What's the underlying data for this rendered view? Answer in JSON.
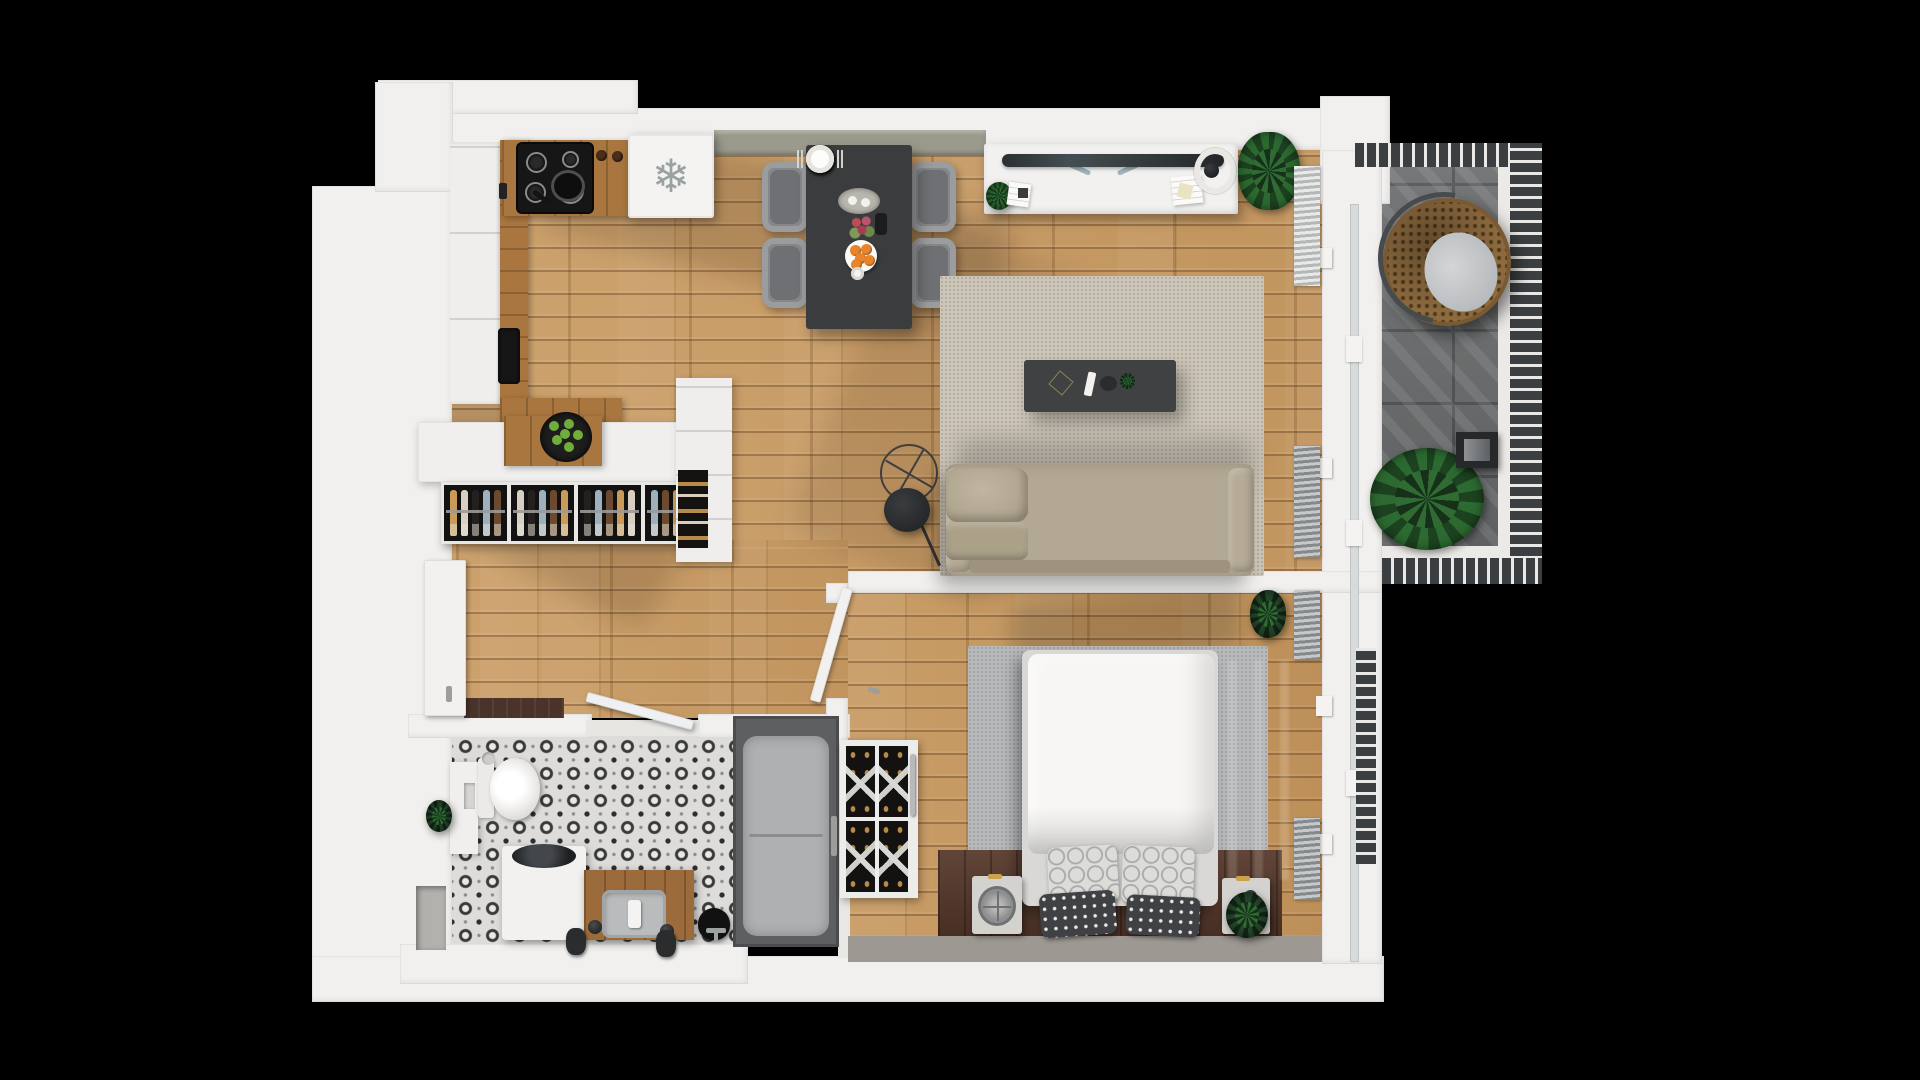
{
  "scene": {
    "kind": "top-down 3d rendered apartment floor plan",
    "background": "#000000",
    "no_visible_text": true
  },
  "palette": {
    "wall": "#f1f0ee",
    "wood": "#c79c67",
    "counter": "#a9763f",
    "sage": "#9b9a8c",
    "table": "#3a3c3d",
    "sofa": "#b3a893",
    "ruglive": "#cdc6b8",
    "rugbed": "#b7b9bb",
    "balcony": "#6e7071",
    "rail": "#3c3f41",
    "tile_dark": "#3a3a3a",
    "tile_light": "#dddcda",
    "plant_green": "#2c6a31",
    "accent_gold": "#c9b06a",
    "orange_fruit": "#e8852c",
    "lime_fruit": "#6fae3a"
  },
  "fridge": {
    "icon_glyph": "❄"
  },
  "rooms": [
    {
      "id": "kitchen",
      "label": "kitchen"
    },
    {
      "id": "dining-area",
      "label": "dining area"
    },
    {
      "id": "living-room",
      "label": "living room"
    },
    {
      "id": "workspace",
      "label": "desk workspace"
    },
    {
      "id": "hallway",
      "label": "entry hallway"
    },
    {
      "id": "bathroom",
      "label": "bathroom"
    },
    {
      "id": "shower-room",
      "label": "shower"
    },
    {
      "id": "bedroom",
      "label": "bedroom"
    },
    {
      "id": "balcony",
      "label": "balcony"
    }
  ],
  "furniture": {
    "kitchen": {
      "burner_count": 4,
      "appliances": [
        "induction-cooktop",
        "frying-pan",
        "refrigerator",
        "black-sink",
        "control-knobs"
      ]
    },
    "dining": {
      "chair_count": 4,
      "place_setting_count": 4,
      "table_items": [
        "serving-platter",
        "flower-bouquet",
        "wine-bottle",
        "plate-of-oranges",
        "espresso-cup"
      ]
    },
    "island": {
      "rack_section_count": 4,
      "bottles_per_section": 5,
      "bottle_colors": [
        "#c99a58",
        "#d8cfc0",
        "#23201d",
        "#9fb0bd",
        "#6b4a2f"
      ],
      "top_items": [
        "cutting-board",
        "bowl-of-limes"
      ]
    },
    "living": {
      "sofa_back_cushion_count": 3,
      "sofa_seat_cushion_count": 3,
      "items": [
        "area-rug",
        "coffee-table",
        "tv-remote",
        "decor-bowl",
        "mini-plant",
        "wire-decor",
        "floor-lamp",
        "shelf-cabinet-with-wine"
      ]
    },
    "workspace": {
      "items": [
        "desk",
        "widescreen-monitor",
        "ring-desk-lamp",
        "book-stack",
        "notepad",
        "desk-plant",
        "palm-plant"
      ]
    },
    "bedroom": {
      "patterned_pillow_count": 2,
      "dark_pillow_count": 2,
      "runner_mat_count": 3,
      "rack_columns": 2,
      "rack_rows": 2,
      "items": [
        "double-bed",
        "gray-rug",
        "fan-unit-nightstand",
        "nightstand",
        "wine-cabinet",
        "corner-plant",
        "open-door"
      ]
    },
    "bathroom": {
      "items": [
        "toilet",
        "washing-machine",
        "white-vanity",
        "wood-vanity-sink",
        "soap-dispenser",
        "waste-bins",
        "plant",
        "watering-kettle",
        "floor-faucet",
        "open-glass-door"
      ]
    },
    "balcony": {
      "blind_panel_count": 4,
      "items": [
        "hanging-egg-chair",
        "large-potted-plant",
        "lantern-speaker"
      ]
    }
  }
}
